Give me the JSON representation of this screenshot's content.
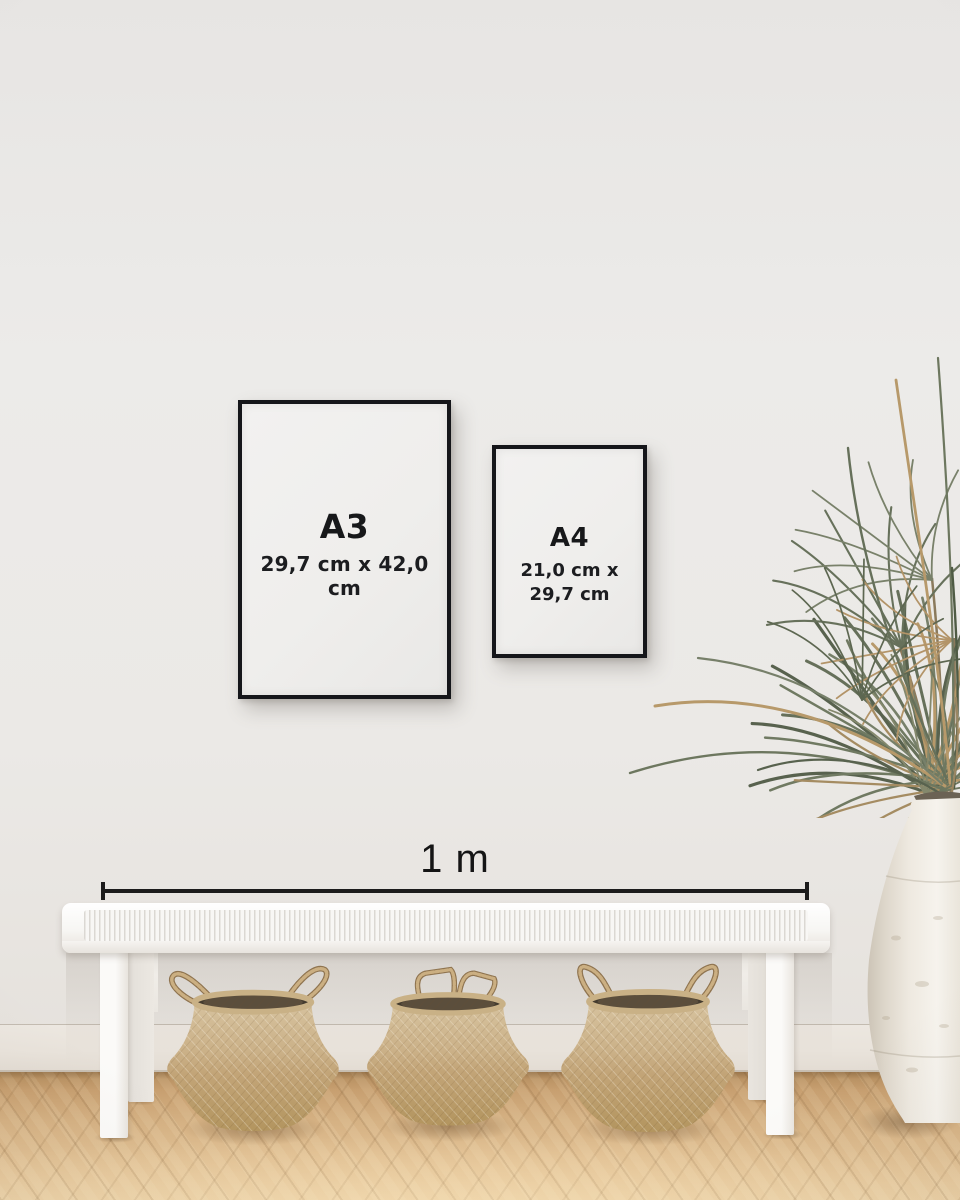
{
  "frames": {
    "a3": {
      "label": "A3",
      "size": "29,7 cm x 42,0 cm"
    },
    "a4": {
      "label": "A4",
      "size_line1": "21,0 cm x",
      "size_line2": "29,7 cm"
    }
  },
  "scale_bar": {
    "label": "1 m"
  },
  "palette": {
    "wall": "#ebe9e6",
    "frame_black": "#15161a",
    "paper_white": "#f1f0ee",
    "text": "#17181a",
    "baseboard": "#e9e3db",
    "floor_dark": "#b28b5c",
    "floor_light": "#e9cda2",
    "bench_white": "#f7f6f3",
    "basket_tan": "#c4a87c",
    "basket_shadow": "#8f7451",
    "rope": "#b1946a",
    "plant_green": "#66705a",
    "plant_dried": "#b7996a",
    "vase_cream": "#f2efe9"
  }
}
